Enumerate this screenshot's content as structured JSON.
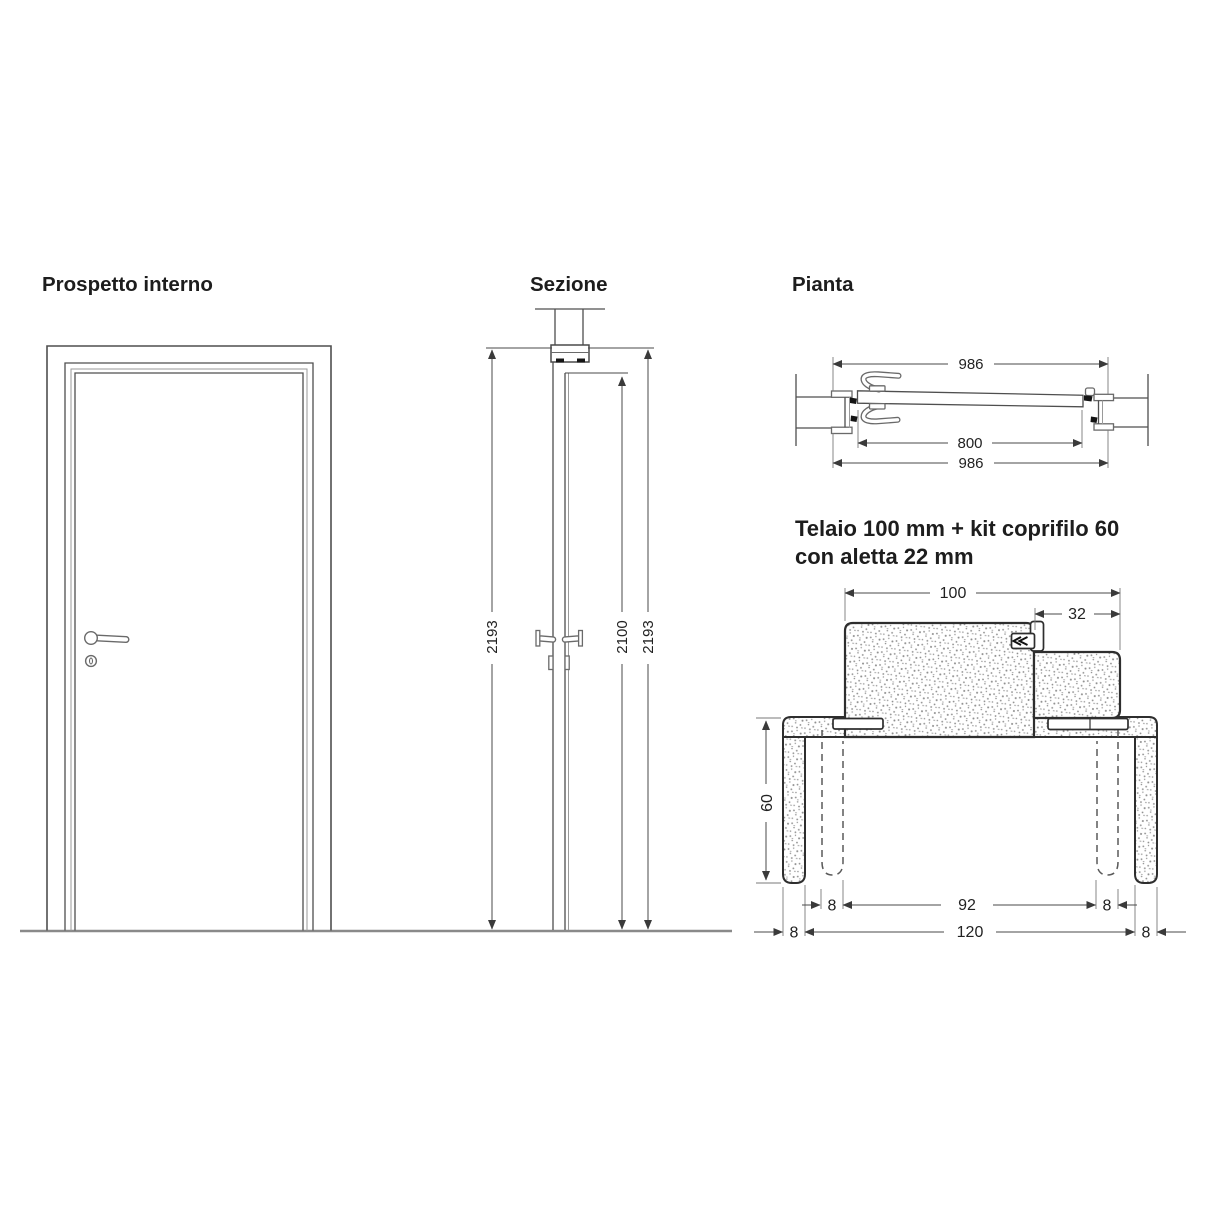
{
  "drawing": {
    "prospetto": {
      "title": "Prospetto interno"
    },
    "sezione": {
      "title": "Sezione",
      "dim_left": "2193",
      "dim_middle": "2100",
      "dim_right": "2193"
    },
    "pianta": {
      "title": "Pianta",
      "dim_top": "986",
      "dim_middle": "800",
      "dim_bottom": "986"
    },
    "telaio": {
      "title_line1": "Telaio 100 mm + kit coprifilo 60",
      "title_line2": "con aletta 22 mm",
      "dim_width": "100",
      "dim_aletta": "32",
      "dim_height": "60",
      "dim_gap_left": "8",
      "dim_inner": "92",
      "dim_gap_right": "8",
      "dim_wall_left": "8",
      "dim_wall": "120",
      "dim_wall_right": "8"
    },
    "colors": {
      "line": "#4f4f4f",
      "dark": "#141414",
      "stipple": "#8f8f8f",
      "text": "#1d1d1d",
      "background": "#ffffff"
    }
  }
}
